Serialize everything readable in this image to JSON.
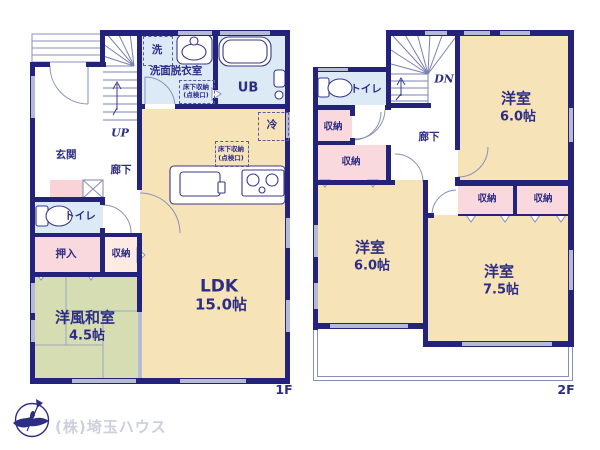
{
  "title": "間取り図 (floor plan)",
  "colors": {
    "wall": "#23237c",
    "room_beige": "#f7e3b8",
    "room_blue": "#dceaf6",
    "room_pink": "#fad9de",
    "room_pale_pink": "#fdeae2",
    "room_green": "#d6ddb2",
    "window_gray": "#b6bad4",
    "thin_line": "#8a90b8",
    "text_navy": "#2d2d85",
    "company_gray": "#cdd0db"
  },
  "floor1": {
    "label": "1F",
    "entrance": "玄関",
    "hallway": "廊下",
    "stairs_up": "UP",
    "washer": "洗",
    "washroom": "洗面脱衣室",
    "underfloor_1": "床下収納",
    "underfloor_2": "(点検口)",
    "bath": "UB",
    "fridge": "冷",
    "toilet": "トイレ",
    "closet": "押入",
    "storage": "収納",
    "ldk": {
      "name": "LDK",
      "size": "15.0帖"
    },
    "washitsu": {
      "name": "洋風和室",
      "size": "4.5帖"
    }
  },
  "floor2": {
    "label": "2F",
    "stairs_down": "DN",
    "toilet": "トイレ",
    "hallway": "廊下",
    "storage": "収納",
    "room_ne": {
      "name": "洋室",
      "size": "6.0帖"
    },
    "room_sw": {
      "name": "洋室",
      "size": "6.0帖"
    },
    "room_se": {
      "name": "洋室",
      "size": "7.5帖"
    }
  },
  "footer": {
    "company": "(株)埼玉ハウス",
    "logo": "compass-bird-logo"
  }
}
